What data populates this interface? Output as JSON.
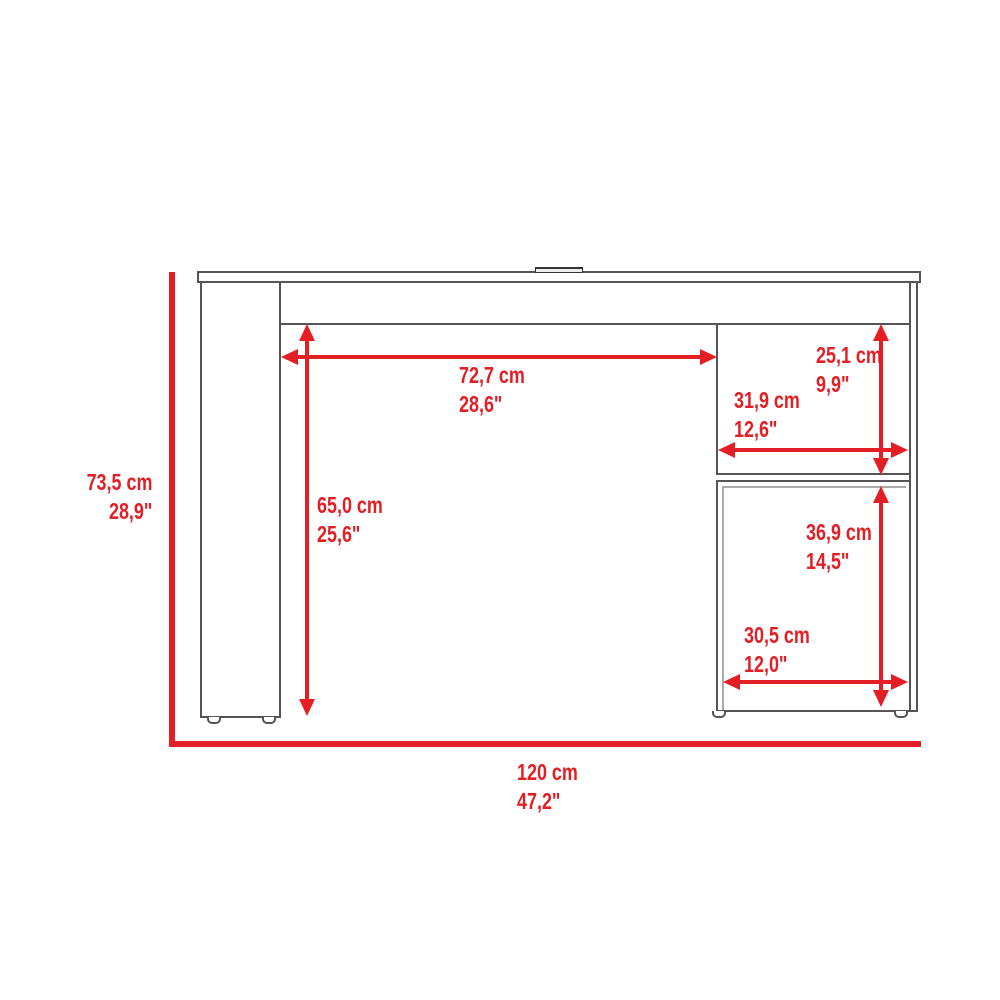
{
  "diagram": {
    "kind": "furniture dimension drawing",
    "accent_color": "#e31e25",
    "outline_color": "#555555"
  },
  "dimensions": {
    "overall_height": {
      "cm": "73,5 cm",
      "inch": "28,9\""
    },
    "overall_width": {
      "cm": "120 cm",
      "inch": "47,2\""
    },
    "kneehole_width": {
      "cm": "72,7 cm",
      "inch": "28,6\""
    },
    "kneehole_height": {
      "cm": "65,0 cm",
      "inch": "25,6\""
    },
    "upper_shelf_height": {
      "cm": "25,1 cm",
      "inch": "9,9\""
    },
    "upper_shelf_width": {
      "cm": "31,9 cm",
      "inch": "12,6\""
    },
    "lower_cabinet_height": {
      "cm": "36,9 cm",
      "inch": "14,5\""
    },
    "lower_cabinet_width": {
      "cm": "30,5 cm",
      "inch": "12,0\""
    }
  }
}
